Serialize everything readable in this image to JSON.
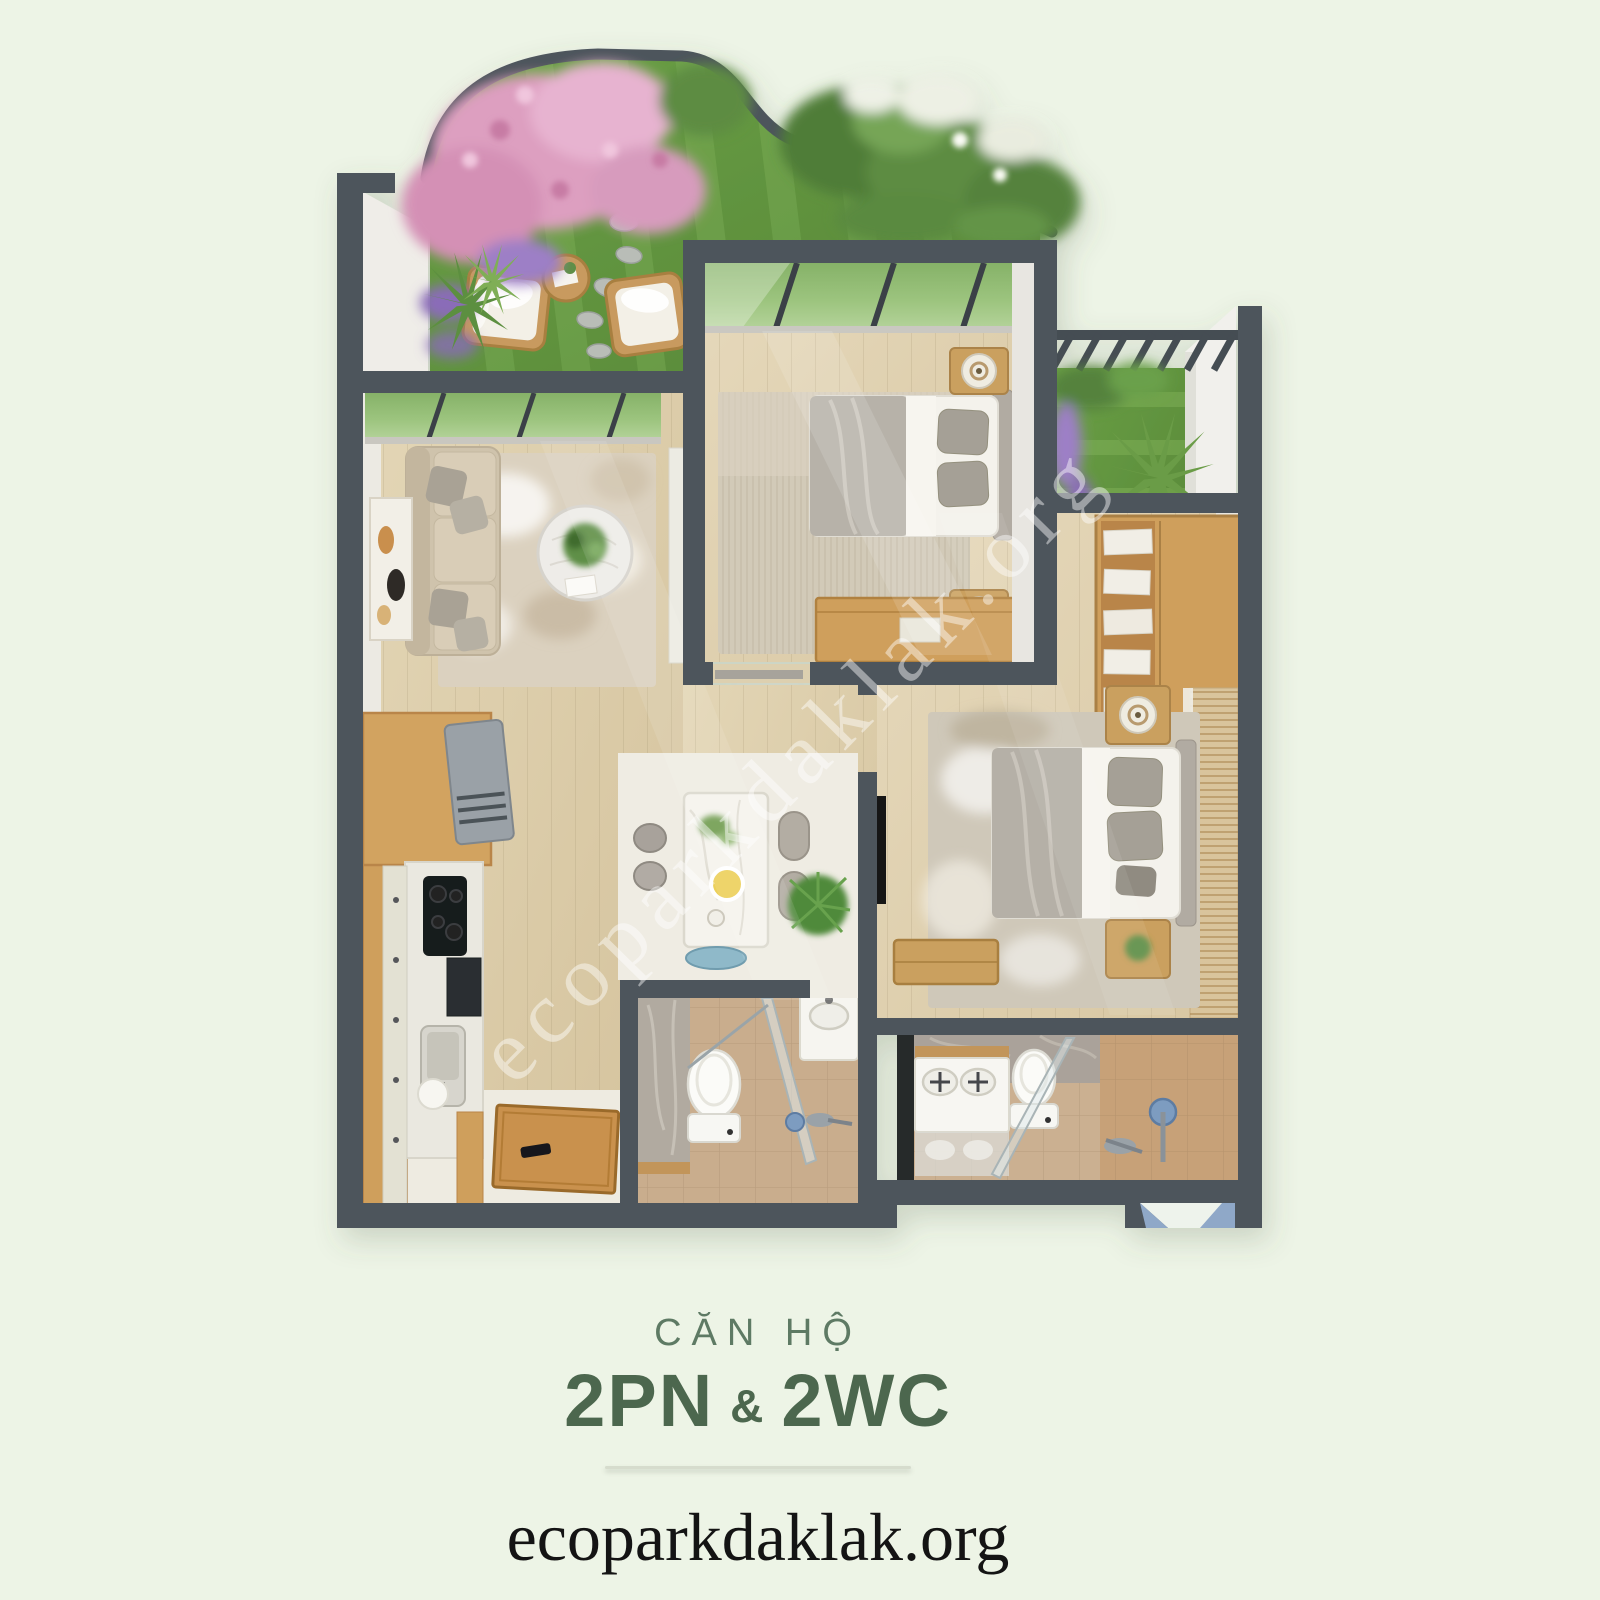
{
  "watermark": {
    "text": "ecoparkdaklak.org"
  },
  "footer": {
    "subtitle": "CĂN HỘ",
    "title_left": "2PN",
    "amp": "&",
    "title_right": "2WC",
    "website": "ecoparkdaklak.org"
  },
  "palette": {
    "background": "#edf4e6",
    "wall": "#4d555c",
    "wood_floor": "#dccdab",
    "white_floor": "#efece3",
    "grass": "#61923f",
    "flower_pink": "#dd9fc0",
    "flower_purple": "#9a7fc6",
    "cabinet_wood": "#cf9f5c",
    "bath_tile": "#c9ad8d",
    "shower_blue": "#7d9cc0",
    "accent_green_dark": "#4c674e",
    "accent_green_mid": "#5e7a64",
    "footer_text_black": "#141414"
  }
}
